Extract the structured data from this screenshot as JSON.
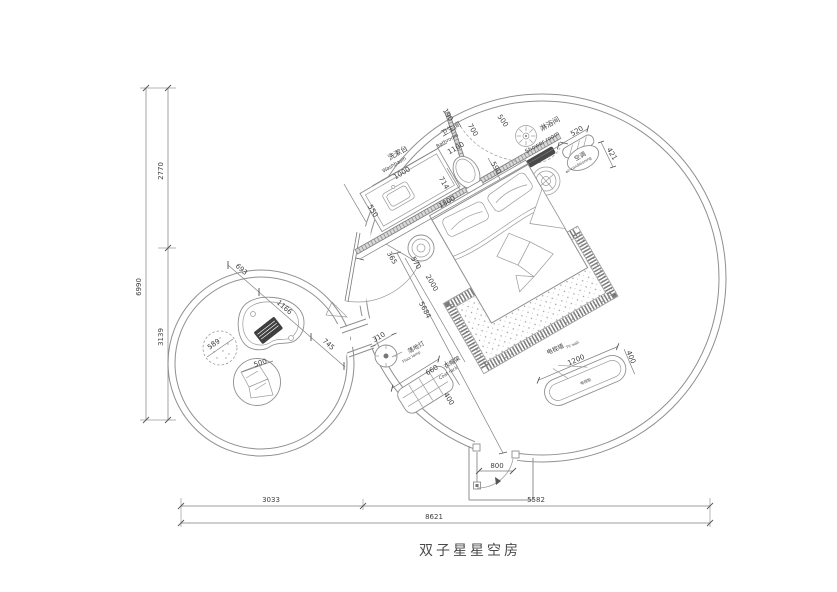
{
  "title": "双子星星空房",
  "colors": {
    "line": "#8f8f8f",
    "wall": "#777777",
    "dark": "#4a4a4a",
    "text": "#3f3f3f",
    "bg": "#ffffff"
  },
  "labels": {
    "bathroom": {
      "zh": "卫生间",
      "en": "Bathroom"
    },
    "washbasin": {
      "zh": "洗漱台",
      "en": "Washbasin"
    },
    "shower": {
      "zh": "淋浴间",
      "en": "Shower room"
    },
    "ac": {
      "zh": "空调",
      "en": "air-conditioning"
    },
    "floor_lamp": {
      "zh": "落地灯",
      "en": "Floor lamp"
    },
    "coat_rack": {
      "zh": "衣帽架",
      "en": "Coat rack"
    },
    "tv_wall": {
      "zh": "电视墙",
      "en": "TV wall"
    },
    "tv_cabinet": "电视柜"
  },
  "dims": {
    "bathroom_width": "1100",
    "washbasin_width": "1000",
    "counter_depth": "550",
    "partition_offset": "190",
    "partition_length": "700",
    "shower_width": "500",
    "ac_width": "520",
    "ac_depth": "421",
    "toilet_width": "714",
    "wall_run": "1800",
    "toilet_clear": "590",
    "bed_gap": "365",
    "nightstand": "570",
    "bed_length": "2000",
    "room_diag": "5684",
    "lamp_dia": "310",
    "coat_rack_len": "660",
    "coat_rack_depth": "400",
    "tv_len": "1200",
    "tv_depth": "400",
    "door_width": "800",
    "lounge_a": "693",
    "lounge_b": "1166",
    "lounge_c": "745",
    "rug_dia": "589",
    "pouf_dia": "500",
    "left_top": "2770",
    "left_bottom": "3139",
    "left_total": "6990",
    "bottom_left": "3033",
    "bottom_right": "5582",
    "bottom_total": "8621"
  }
}
